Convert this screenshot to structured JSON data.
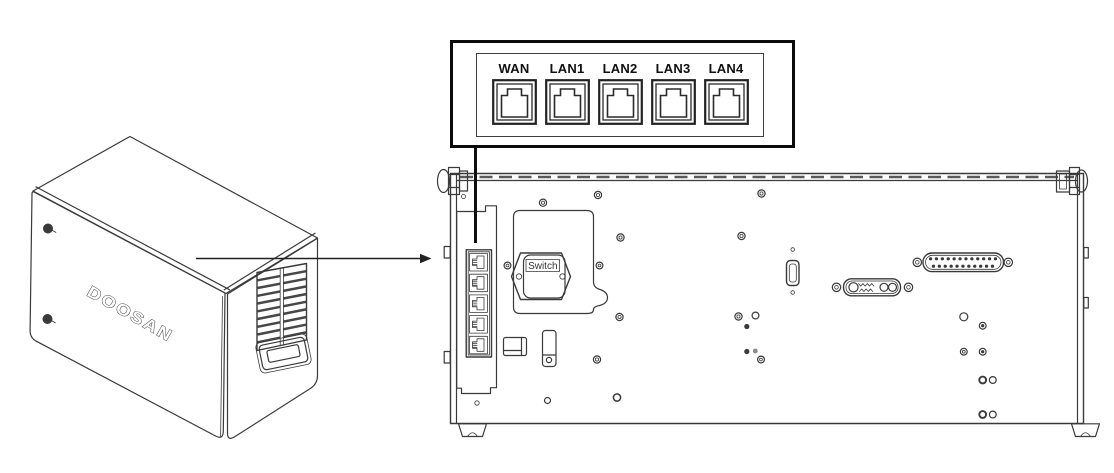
{
  "diagram": {
    "device": {
      "brand_logo": "DOOSAN"
    },
    "callout": {
      "ports": [
        {
          "label": "WAN"
        },
        {
          "label": "LAN1"
        },
        {
          "label": "LAN2"
        },
        {
          "label": "LAN3"
        },
        {
          "label": "LAN4"
        }
      ]
    },
    "rear_panel": {
      "switch_label": "Switch"
    },
    "colors": {
      "line": "#3a3a3a",
      "callout_border": "#0b0b0b",
      "leader_line": "#0f0f0f",
      "background": "#ffffff"
    },
    "icons": {
      "port": "rj45-port-icon",
      "pointer": "arrow-right-icon"
    }
  }
}
